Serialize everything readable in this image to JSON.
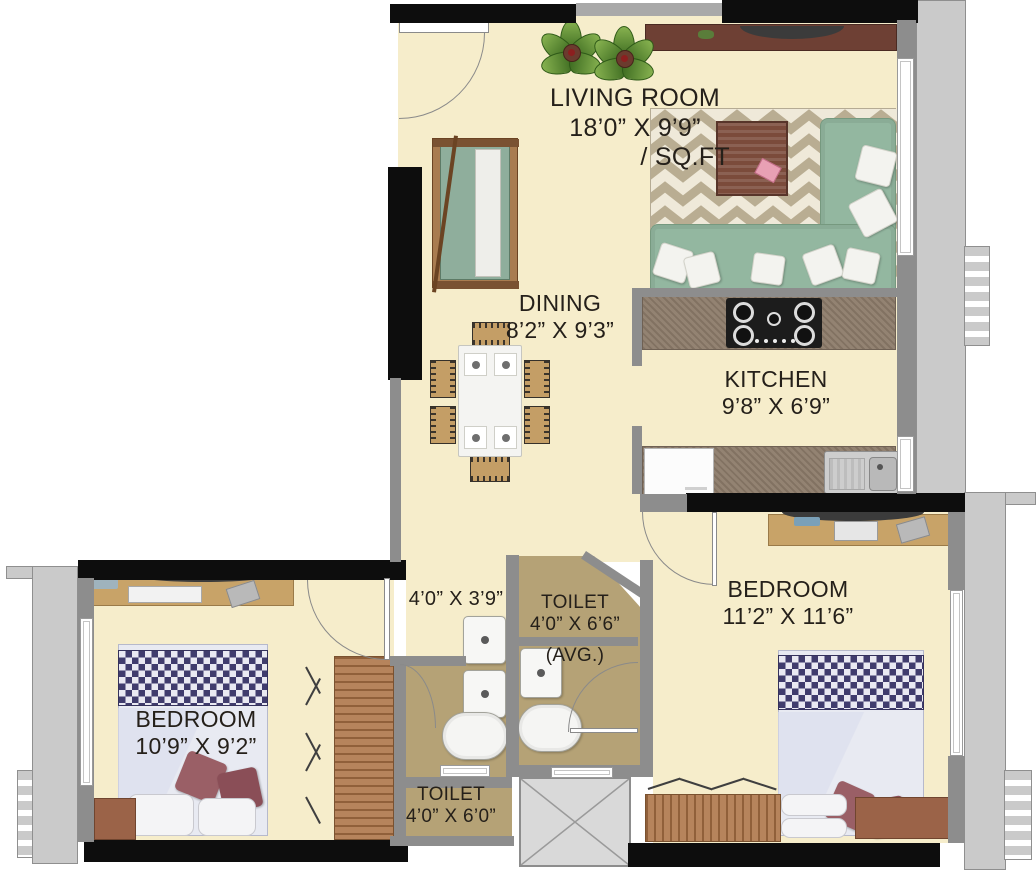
{
  "rooms": {
    "living_room": {
      "label": "LIVING ROOM",
      "dimensions": "18’0” X 9’9”",
      "area_suffix": "/ SQ.FT"
    },
    "dining": {
      "label": "DINING",
      "dimensions": "8’2” X 9’3”"
    },
    "kitchen": {
      "label": "KITCHEN",
      "dimensions": "9’8” X 6’9”"
    },
    "bedroom_master": {
      "label": "BEDROOM",
      "dimensions": "11’2” X 11’6”"
    },
    "bedroom_second": {
      "label": "BEDROOM",
      "dimensions": "10’9” X 9’2”"
    },
    "passage": {
      "dimensions": "4’0” X 3’9”"
    },
    "toilet_attached": {
      "label": "TOILET",
      "dimensions": "4’0” X 6’6”",
      "note": "(AVG.)"
    },
    "toilet_common": {
      "label": "TOILET",
      "dimensions": "4’0” X 6’0”"
    }
  },
  "colors": {
    "floor_cream": "#f6edcb",
    "toilet_floor_tan": "#b5a276",
    "wall_dark": "#0d0d0d",
    "wall_gray": "#8d8d8d",
    "exterior_ledge_gray": "#cacaca",
    "sofa_green": "#93b7a0",
    "rug_beige": "#efe9d9",
    "rug_chevron": "#b9ad92",
    "wood_brown": "#ad7a4c",
    "tv_console_brown": "#6e4034",
    "granite_brown": "#8d7c6a",
    "bed_linen": "#e8eaf2",
    "headboard_navy": "#403c6d",
    "pillow_maroon": "#9a5f66",
    "lift_gray": "#d9d9d9"
  }
}
